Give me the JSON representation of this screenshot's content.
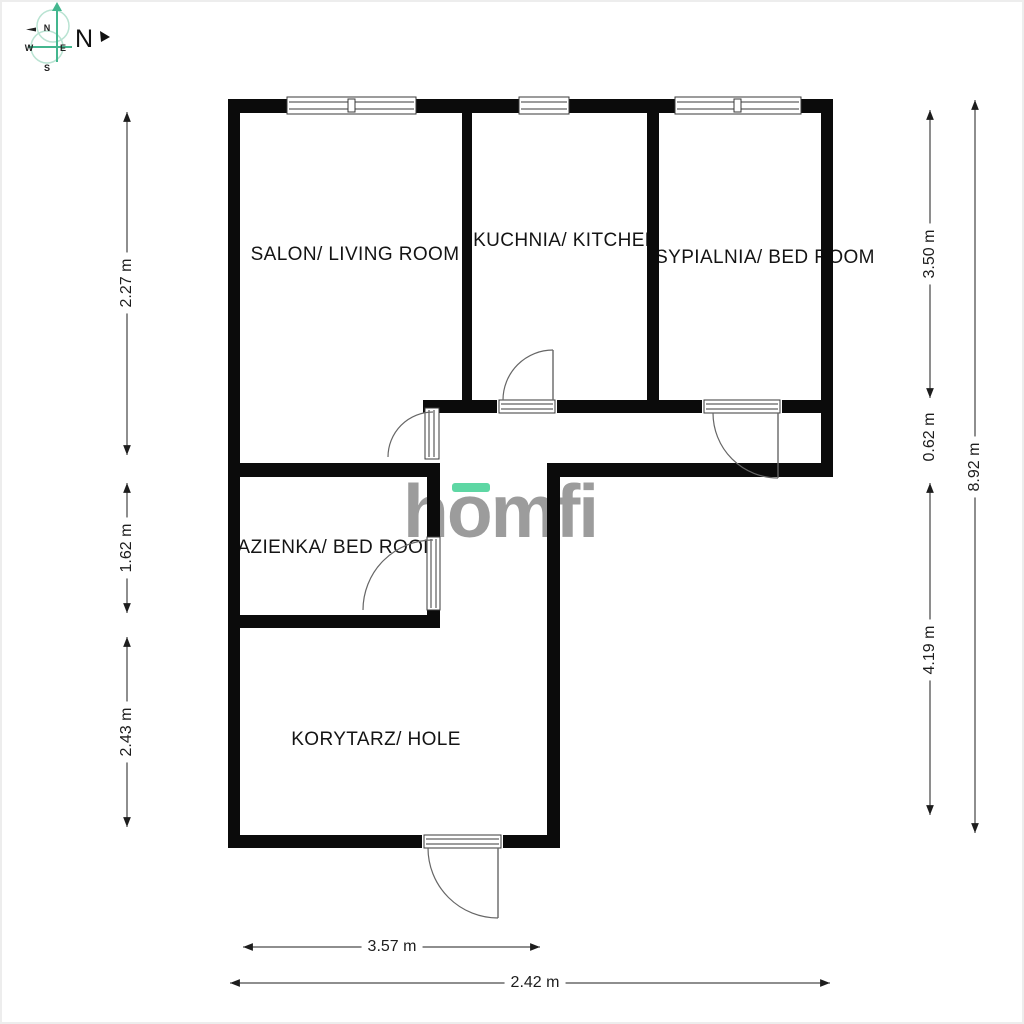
{
  "compass": {
    "north": "N",
    "n": "N",
    "w": "W",
    "e": "E",
    "s": "S"
  },
  "watermark": {
    "text": "homfi"
  },
  "rooms": [
    {
      "label": "SALON/ LIVING ROOM"
    },
    {
      "label": "KUCHNIA/ KITCHEN"
    },
    {
      "label": "SYPIALNIA/ BED ROOM"
    },
    {
      "label": "LAZIENKA/ BED ROOM"
    },
    {
      "label": "KORYTARZ/ HOLE"
    }
  ],
  "dimensions": {
    "left": [
      "2.27 m",
      "1.62 m",
      "2.43 m"
    ],
    "right": [
      "3.50 m",
      "0.62 m",
      "4.19 m",
      "8.92 m"
    ],
    "bottom": [
      "3.57 m",
      "2.42 m"
    ]
  },
  "colors": {
    "wall": "#0b0b0b",
    "accent_green": "#5ed7a4",
    "logo_gray": "#9c9c9c",
    "compass_green": "#43b68e",
    "compass_circle": "#b9e3d2"
  }
}
